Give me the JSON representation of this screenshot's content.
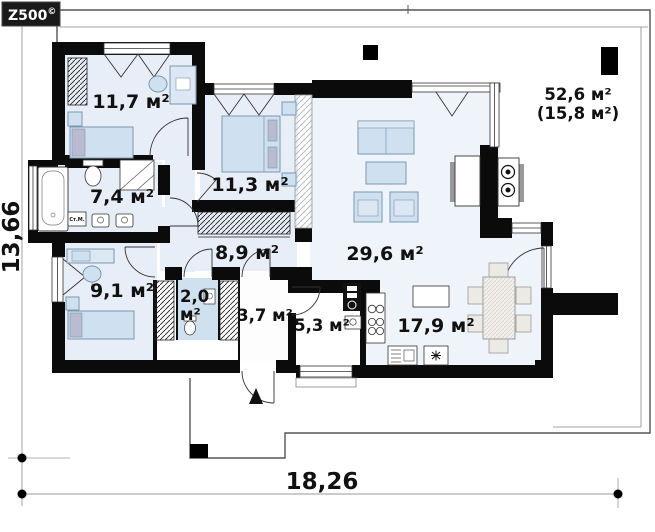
{
  "brand": {
    "name": "Z500",
    "mark": "©"
  },
  "dimensions": {
    "width": "18,26",
    "height": "13,66"
  },
  "rooms": {
    "bedroom_top_left": {
      "area": "11,7 м²"
    },
    "bathroom": {
      "area": "7,4 м²"
    },
    "bedroom_middle": {
      "area": "11,3 м²"
    },
    "hallway": {
      "area": "8,9 м²"
    },
    "living_room": {
      "area": "29,6 м²"
    },
    "bedroom_bottom_left": {
      "area": "9,1 м²"
    },
    "wc": {
      "area_value": "2,0",
      "area_unit": "м²"
    },
    "entry": {
      "area": "3,7 м²"
    },
    "utility": {
      "area": "5,3 м²"
    },
    "kitchen_dining": {
      "area": "17,9 м²"
    },
    "terrace": {
      "area": "52,6 м²",
      "area_net": "(15,8 м²)"
    }
  },
  "labels": {
    "washing_machine": "Ст.М."
  },
  "colors": {
    "wall": "#0b0b0b",
    "floor": "#e8eef7",
    "floor_living": "#eef4fa",
    "floor_wc": "#cfe0ef",
    "furniture": "#cfe1f1",
    "furniture_stroke": "#7d96ad",
    "pillow": "#b9bcd1"
  }
}
